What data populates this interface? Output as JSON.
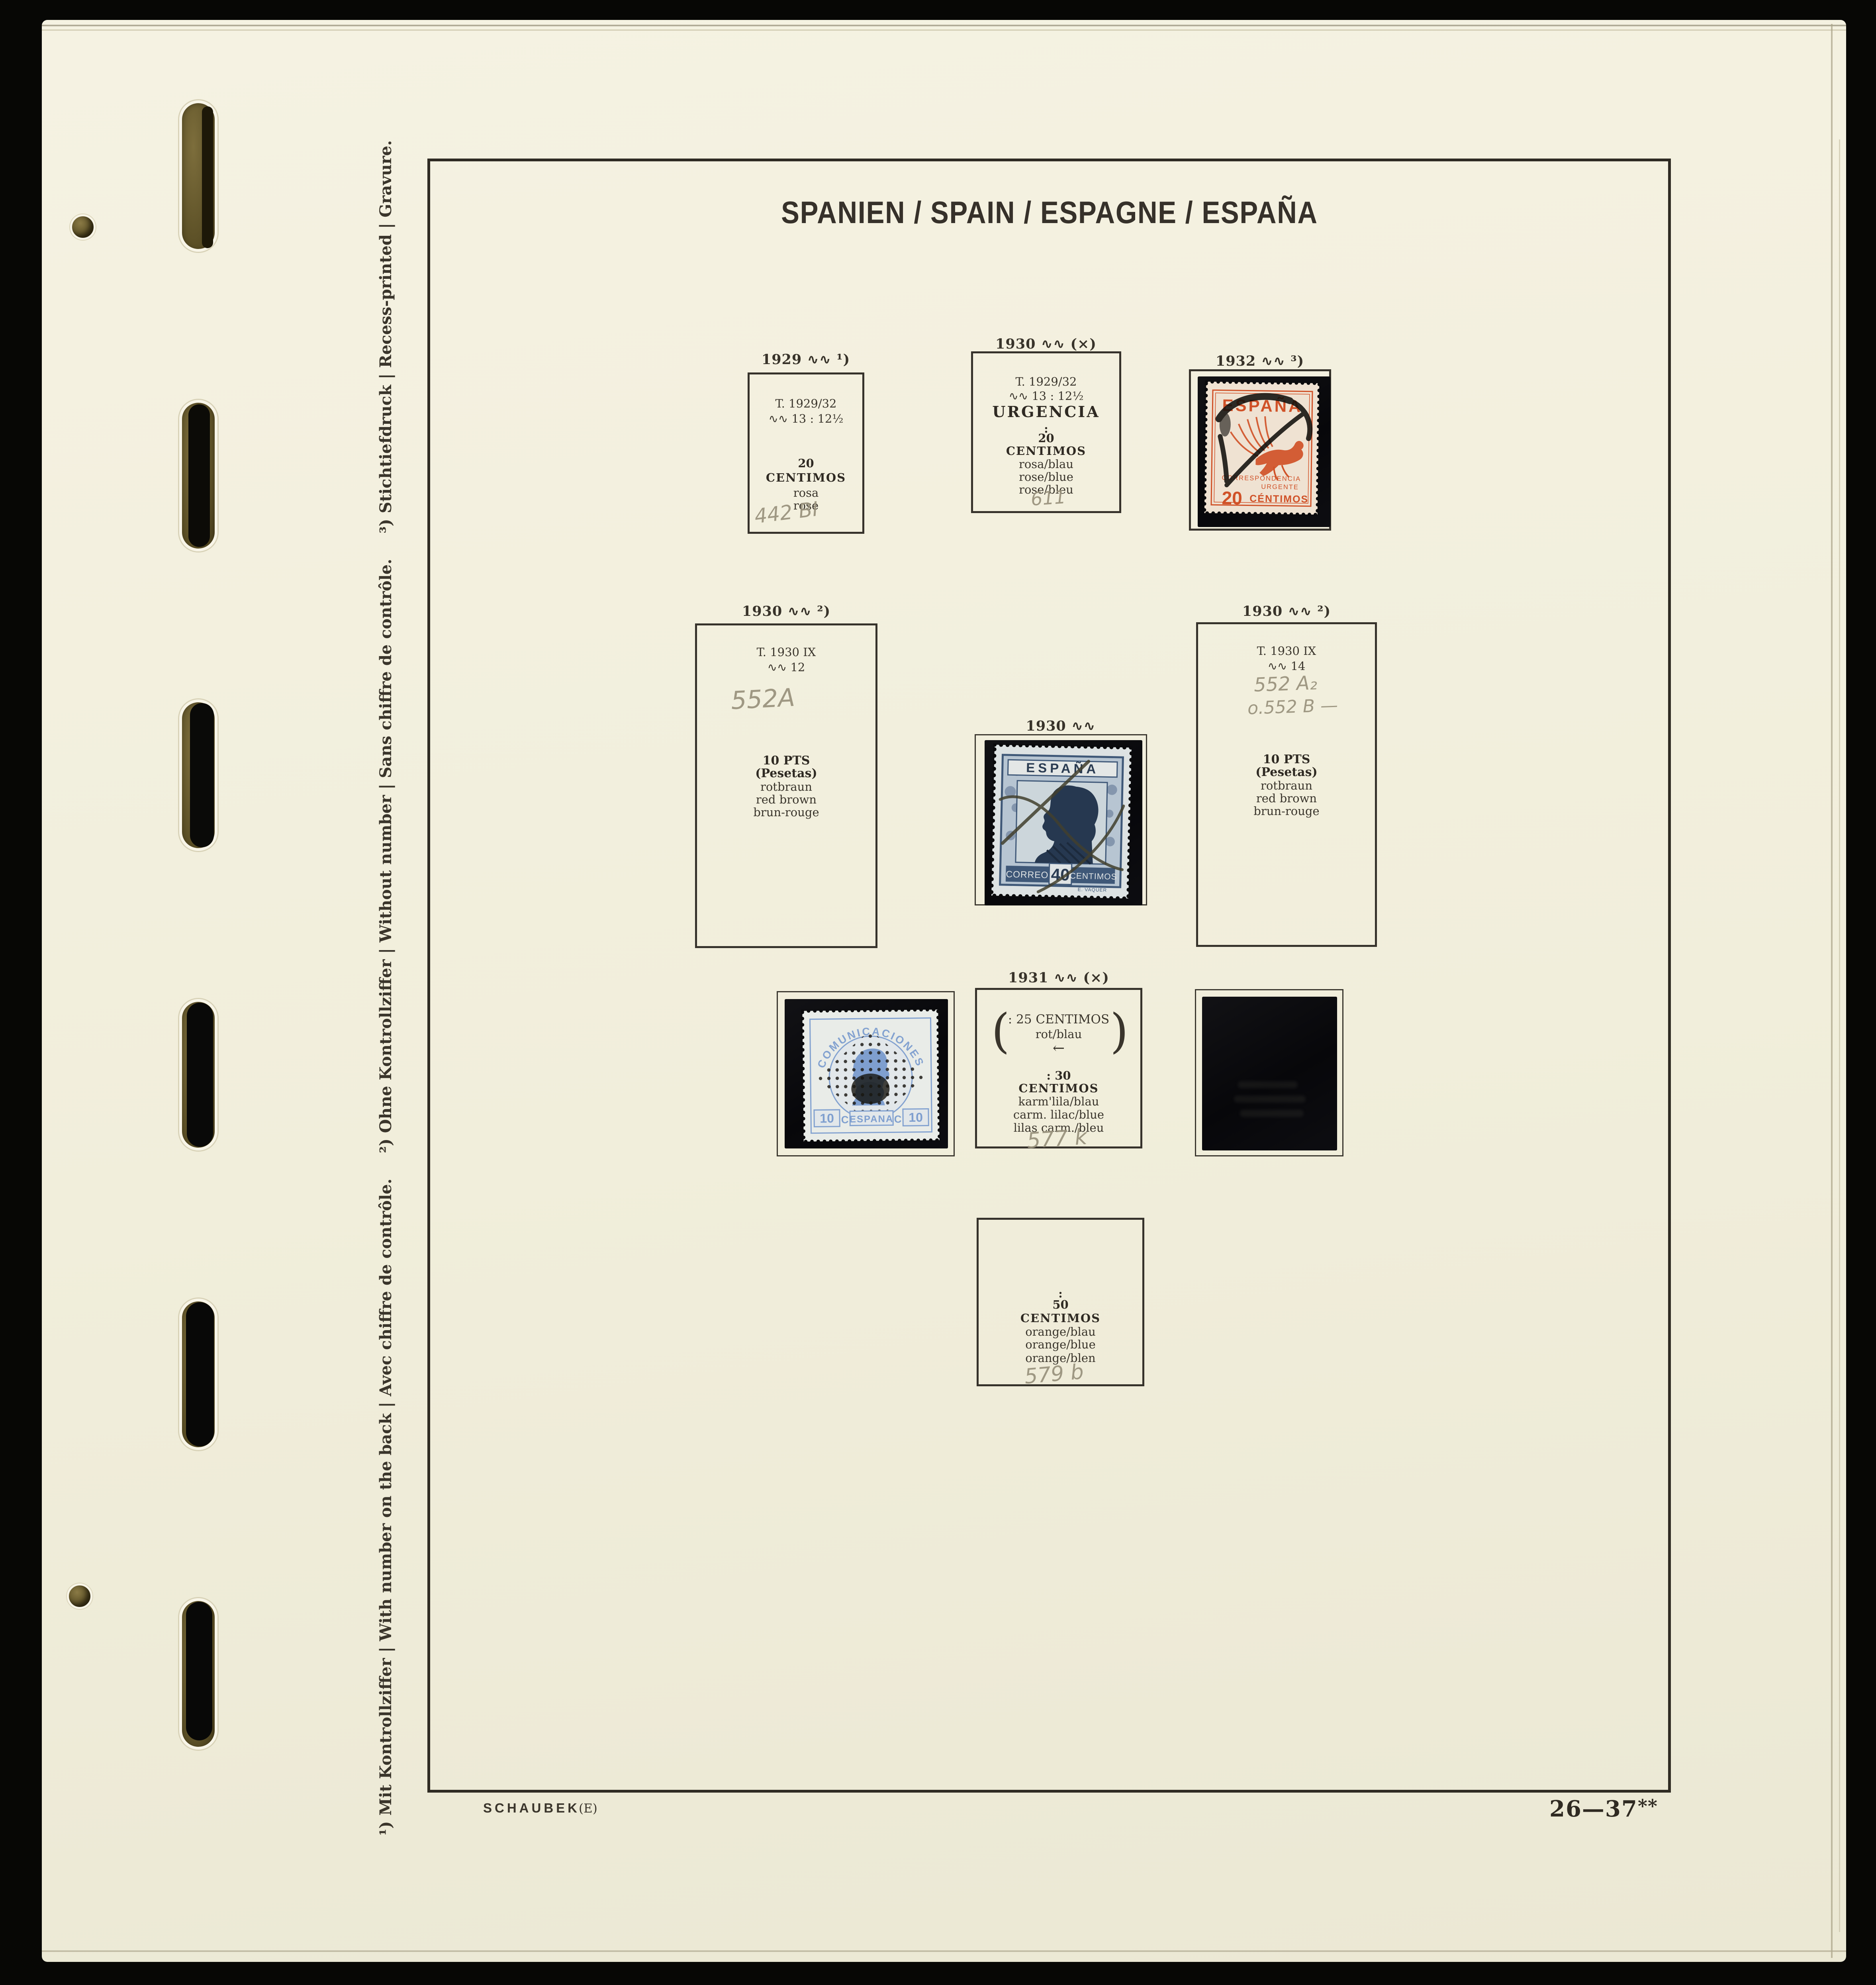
{
  "window": {
    "title": "SPANIEN / SPAIN / ESPAGNE / ESPAÑA"
  },
  "footer": {
    "publisher": "SCHAUBEK",
    "edition_mark": "(E)",
    "page_number": "26—37",
    "page_suffix": "**"
  },
  "footnotes": {
    "f1": "¹) Mit Kontrollziffer | With number on the back | Avec chiffre de contrôle.",
    "f2": "²) Ohne Kontrollziffer | Without number | Sans chiffre de contrôle.",
    "f3": "³) Stichtiefdruck | Recess-printed | Gravure."
  },
  "boxes": {
    "y1929": {
      "caption": "1929 ∿∿ ¹)",
      "type_line": "T. 1929/32",
      "perf_line": "∿∿ 13 : 12½",
      "value": "20",
      "unit": "CENTIMOS",
      "color_de": "rosa",
      "color_fr": "rose",
      "pencil": "442 BI"
    },
    "urg1930": {
      "caption": "1930 ∿∿ (×)",
      "type_line": "T. 1929/32",
      "perf_line": "∿∿ 13 : 12½",
      "name": "URGENCIA",
      "colon": ":",
      "value": "20",
      "unit": "CENTIMOS",
      "color_de": "rosa/blau",
      "color_en": "rose/blue",
      "color_fr": "rose/bleu",
      "pencil": "611"
    },
    "y1932": {
      "caption": "1932 ∿∿ ³)"
    },
    "p12": {
      "caption": "1930 ∿∿ ²)",
      "type_line": "T. 1930 IX",
      "perf_line": "∿∿ 12",
      "pencil": "552A",
      "value": "10 PTS",
      "unit": "(Pesetas)",
      "color_de": "rotbraun",
      "color_en": "red brown",
      "color_fr": "brun-rouge"
    },
    "mid1930": {
      "caption": "1930 ∿∿"
    },
    "p14": {
      "caption": "1930 ∿∿ ²)",
      "type_line": "T. 1930 IX",
      "perf_line": "∿∿ 14",
      "pencil1": "552 A₂",
      "pencil2": "o.552 B —",
      "value": "10 PTS",
      "unit": "(Pesetas)",
      "color_de": "rotbraun",
      "color_en": "red brown",
      "color_fr": "brun-rouge"
    },
    "y1931": {
      "caption": "1931 ∿∿ (×)",
      "paren_open": "(",
      "paren_close": ")",
      "ref_line": ": 25 CENTIMOS",
      "ref_color": "rot/blau",
      "arrow": "←",
      "value_line": ": 30",
      "unit": "CENTIMOS",
      "color_de": "karm'lila/blau",
      "color_en": "carm. lilac/blue",
      "color_fr": "lilas carm./bleu",
      "pencil": "577 k"
    },
    "c50": {
      "colon": ":",
      "value": "50",
      "unit": "CENTIMOS",
      "color_de": "orange/blau",
      "color_en": "orange/blue",
      "color_fr": "orange/blen",
      "pencil": "579 b"
    }
  },
  "stamps": {
    "pegasus": {
      "country": "ESPAÑA",
      "band1": "CORRESPONDENCIA",
      "band2": "URGENTE",
      "value": "20",
      "unit": "CÉNTIMOS"
    },
    "alfonso": {
      "country": "ESPAÑA",
      "left": "CORREOS",
      "value": "40",
      "right": "CENTIMOS",
      "engraver": "E. VAQUER"
    },
    "amadeo": {
      "top": "COMUNICACIONES",
      "v_left": "10",
      "c_left": "C",
      "country": "ESPANA",
      "c_right": "C",
      "v_right": "10"
    }
  },
  "colors": {
    "background": "#070705",
    "paper": "#f2efde",
    "ink": "#332e25",
    "pencil": "#95907e",
    "stamp_orange": "#d05127",
    "stamp_blue": "#3f5878",
    "stamp_light_blue": "#83a2d0",
    "mount_black": "#0b0b0d"
  }
}
